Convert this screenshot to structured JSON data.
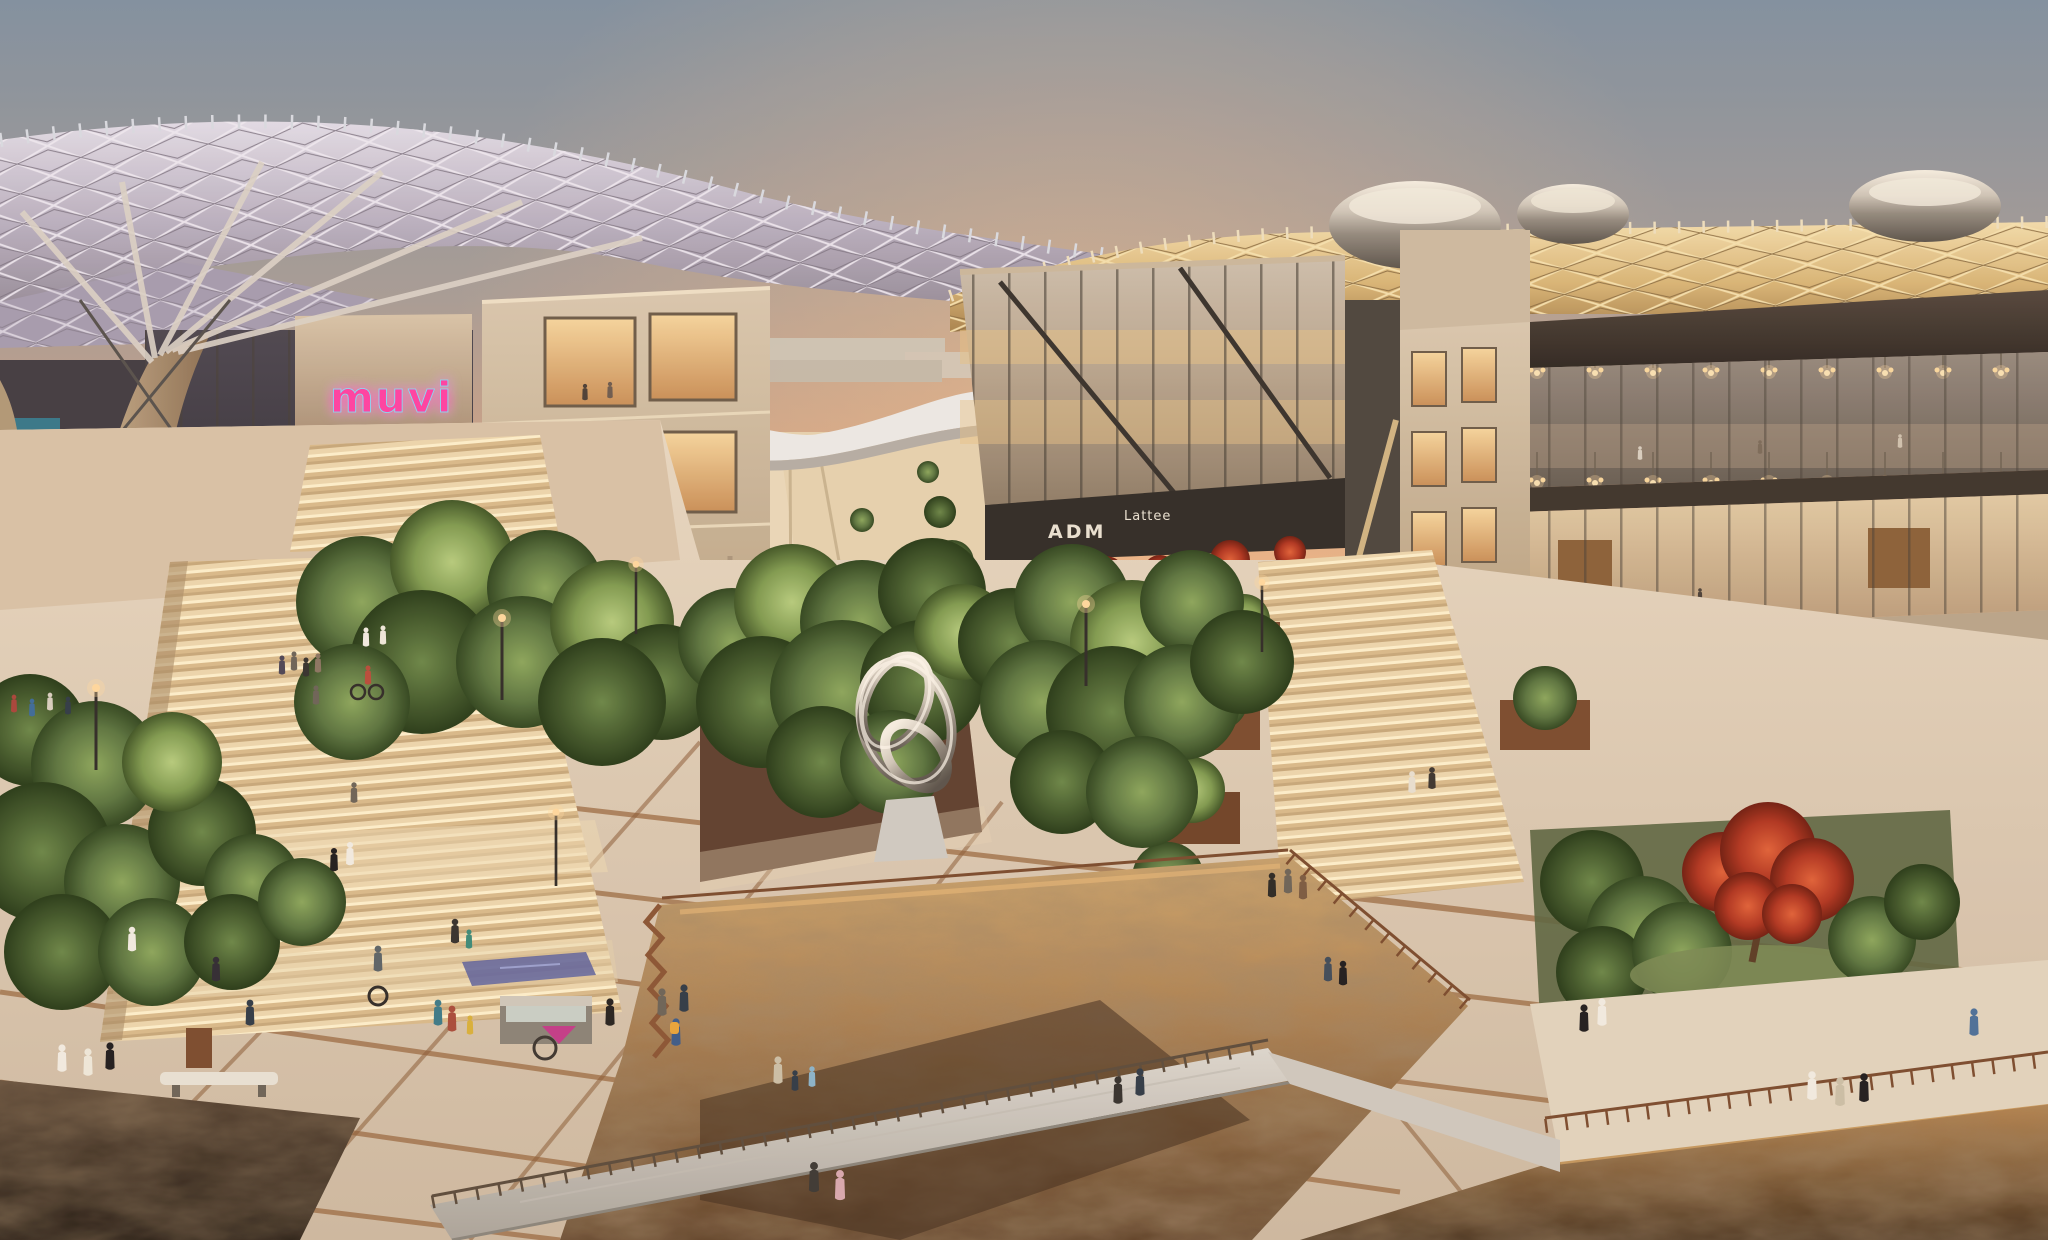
{
  "meta": {
    "type": "architectural-render",
    "setting": "mixed-use urban district at dusk with shade canopy, plazas, wadi excavation and terraces"
  },
  "signs": {
    "cinema_neon": "muvi",
    "boutique": "SOCIA",
    "boutique_tagline": "society",
    "boutique_side": "SOCIA",
    "gallery": "ADM",
    "cafe": "Lattee"
  },
  "palette": {
    "sky_top": "#7f90a2",
    "sky_mid": "#c2a28e",
    "sky_horizon": "#f0b887",
    "canopy_grey": "#b4abbe",
    "canopy_gold": "#d9b678",
    "stone": "#cdb9a0",
    "bronze": "#3c322a",
    "glass_warm": "#e8c388",
    "foliage": "#55703c",
    "flame_tree": "#c23f28",
    "corten": "#8a5a36",
    "paving": "#e0d0bb",
    "rock": "#9a7450",
    "neon_pink": "#ff3fa4",
    "neon_blue": "#39c8f0",
    "sign_text": "#e9e2d4",
    "sculpture_chrome": "#d8d4cc",
    "umbrella": "#f2efe8"
  }
}
